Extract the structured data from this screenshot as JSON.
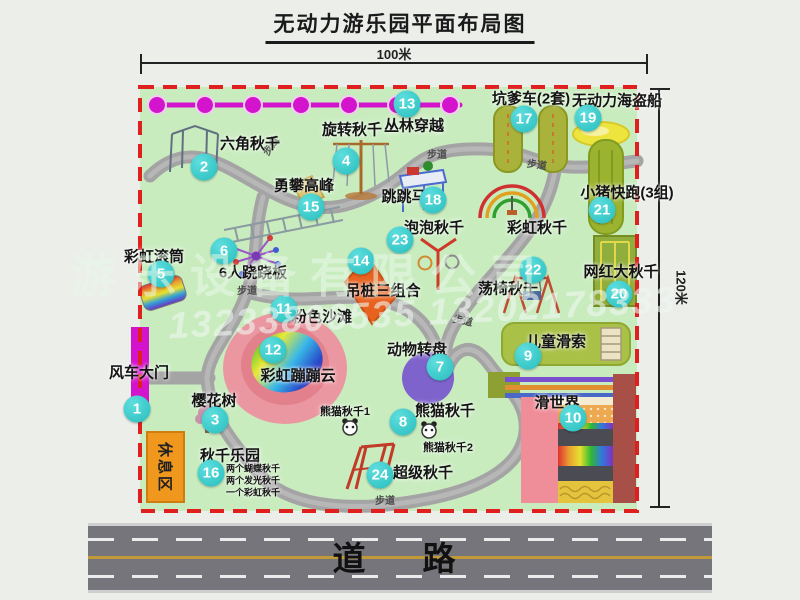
{
  "title": "无动力游乐园平面布局图",
  "dimensions": {
    "width": "100米",
    "height": "120米"
  },
  "road": {
    "label": "道　路"
  },
  "rest_area": {
    "label": "休息区"
  },
  "path_label": "步道",
  "watermark": {
    "line1": "游乐设备有限公司",
    "line2": "13233806535 13202178333"
  },
  "extra_labels": {
    "rainbow_swing": "彩虹秋千"
  },
  "panda_notes": [
    "熊猫秋千1",
    "熊猫秋千2"
  ],
  "swing_notes": [
    "两个蝴蝶秋千",
    "两个发光秋千",
    "一个彩虹秋千"
  ],
  "attractions": [
    {
      "num": "1",
      "name": "风车大门"
    },
    {
      "num": "2",
      "name": "六角秋千"
    },
    {
      "num": "3",
      "name": "樱花树"
    },
    {
      "num": "4",
      "name": "旋转秋千"
    },
    {
      "num": "5",
      "name": "彩虹滚筒"
    },
    {
      "num": "6",
      "name": "6人跷跷板"
    },
    {
      "num": "7",
      "name": "动物转盘"
    },
    {
      "num": "8",
      "name": "熊猫秋千"
    },
    {
      "num": "9",
      "name": "儿童滑索"
    },
    {
      "num": "10",
      "name": "滑世界"
    },
    {
      "num": "11",
      "name": "粉色沙滩"
    },
    {
      "num": "12",
      "name": "彩虹蹦蹦云"
    },
    {
      "num": "13",
      "name": "丛林穿越"
    },
    {
      "num": "14",
      "name": "吊桩三组合"
    },
    {
      "num": "15",
      "name": "勇攀高峰"
    },
    {
      "num": "16",
      "name": "秋千乐园"
    },
    {
      "num": "17",
      "name": "坑爹车(2套)"
    },
    {
      "num": "18",
      "name": "跳跳马"
    },
    {
      "num": "19",
      "name": "无动力海盗船"
    },
    {
      "num": "20",
      "name": "网红大秋千"
    },
    {
      "num": "21",
      "name": "小猪快跑(3组)"
    },
    {
      "num": "22",
      "name": "荡椅秋千"
    },
    {
      "num": "23",
      "name": "泡泡秋千"
    },
    {
      "num": "24",
      "name": "超级秋千"
    }
  ],
  "colors": {
    "map_green": "#c9ecbf",
    "border_red": "#e01f1f",
    "badge_teal": "#2fc6c6",
    "magenta": "#d414cc",
    "road_gray": "#75757b",
    "rest_orange": "#f0971e"
  }
}
